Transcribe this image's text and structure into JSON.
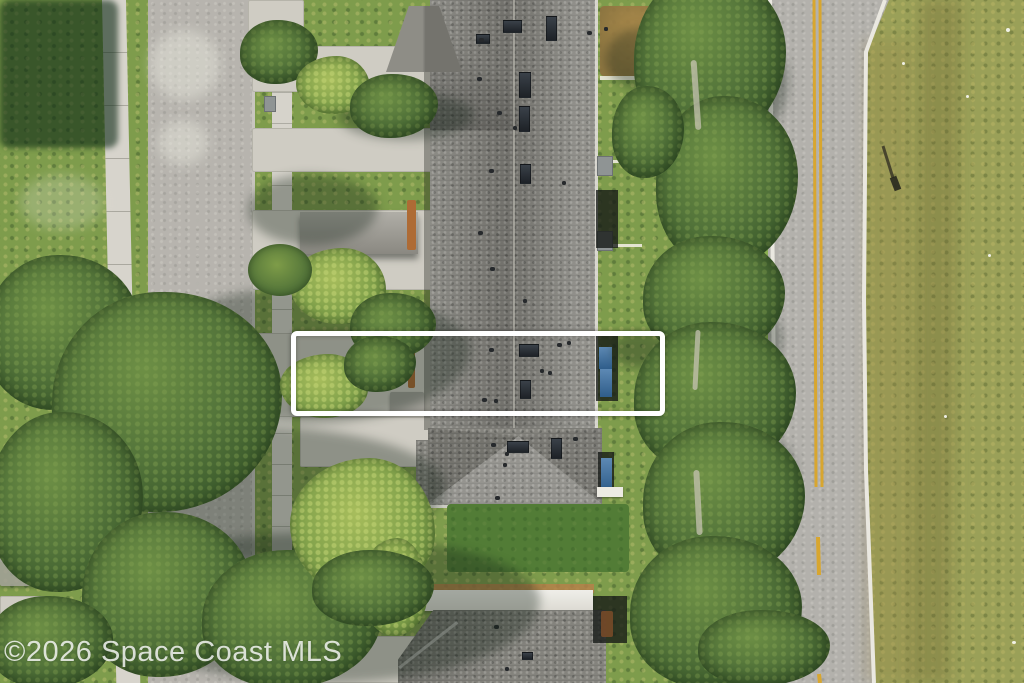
{
  "scene": {
    "kind": "aerial-drone-photo",
    "subject": "townhome community between residential street and two-lane road",
    "width": 1024,
    "height": 683
  },
  "watermark": {
    "text": "©2026 Space Coast MLS"
  },
  "highlight_box": {
    "x": 291,
    "y": 331,
    "w": 374,
    "h": 85,
    "border_color": "#ffffff",
    "border_px": 5
  },
  "palette": {
    "grass": "#7e9c4c",
    "field": "#9aa058",
    "street": "#b7b4ae",
    "road": "#b3b1ac",
    "concrete": "#d7d4cc",
    "roof": "#84837d",
    "back_lawn": "#527c36",
    "yellow_line": "#d8a62f",
    "white_line": "#eae8e0",
    "tree": "#53743a",
    "dirt_yard": "#a9824a"
  },
  "markings": [
    {
      "name": "road-edge-line-left",
      "d": "M770,0 L777,683",
      "stroke": "#eae8e0",
      "w": 4
    },
    {
      "name": "road-edge-line-right",
      "d": "M885,0 L866,52 L864,300 L866,470 L874,683",
      "stroke": "#eae8e0",
      "w": 4
    },
    {
      "name": "center-line-yellow-1",
      "d": "M814,0 L816,487",
      "stroke": "#d8a62f",
      "w": 3
    },
    {
      "name": "center-line-yellow-2",
      "d": "M820,0 L822,487",
      "stroke": "#d8a62f",
      "w": 3
    },
    {
      "name": "center-line-dash",
      "d": "M818,537 L819,575",
      "stroke": "#d8a62f",
      "w": 4
    },
    {
      "name": "center-line-dash",
      "d": "M819,674 L820,683",
      "stroke": "#d8a62f",
      "w": 4
    },
    {
      "name": "streetlight-shadow",
      "d": "M287,612 L300,592 L333,671",
      "stroke": "rgba(35,38,32,0.8)",
      "w": 3
    },
    {
      "name": "pole-shadow",
      "d": "M883,146 L893,178",
      "stroke": "rgba(50,48,35,0.8)",
      "w": 3
    },
    {
      "name": "pole-shadow-head",
      "d": "M893,177 L898,190",
      "stroke": "rgba(40,40,30,0.9)",
      "w": 7
    }
  ],
  "sprites": {
    "ground": [
      {
        "n": "driveway",
        "c": "concrete-pad",
        "x": 248,
        "y": 0,
        "w": 56,
        "h": 40
      },
      {
        "n": "driveway",
        "c": "concrete-pad",
        "x": 252,
        "y": 46,
        "w": 180,
        "h": 46
      },
      {
        "n": "driveway",
        "c": "concrete-pad",
        "x": 252,
        "y": 128,
        "w": 180,
        "h": 44
      },
      {
        "n": "driveway",
        "c": "concrete-pad",
        "x": 252,
        "y": 210,
        "w": 180,
        "h": 80
      },
      {
        "n": "driveway",
        "c": "concrete-pad",
        "x": 252,
        "y": 333,
        "w": 180,
        "h": 84
      },
      {
        "n": "driveway",
        "c": "concrete-pad",
        "x": 300,
        "y": 417,
        "w": 132,
        "h": 50
      },
      {
        "n": "driveway",
        "c": "concrete-pad",
        "x": 252,
        "y": 636,
        "w": 180,
        "h": 47
      },
      {
        "n": "walk-path",
        "c": "concrete-pad",
        "x": 0,
        "y": 455,
        "w": 112,
        "h": 26
      },
      {
        "n": "walk-path",
        "c": "concrete-pad",
        "x": 0,
        "y": 538,
        "w": 58,
        "h": 24
      },
      {
        "n": "walk-path",
        "c": "concrete-pad",
        "x": 0,
        "y": 596,
        "w": 46,
        "h": 28
      },
      {
        "n": "path-behind-trees",
        "c": "concrete-pad",
        "x": 710,
        "y": 74,
        "w": 32,
        "h": 40
      },
      {
        "n": "path-behind-trees",
        "c": "concrete-pad",
        "x": 712,
        "y": 166,
        "w": 30,
        "h": 46
      },
      {
        "n": "path-behind-trees",
        "c": "concrete-pad",
        "x": 713,
        "y": 290,
        "w": 28,
        "h": 42
      },
      {
        "n": "pavement-blotch",
        "c": "blotch",
        "x": 150,
        "y": 30,
        "w": 70,
        "h": 70
      },
      {
        "n": "pavement-blotch",
        "c": "blotch",
        "x": 158,
        "y": 120,
        "w": 50,
        "h": 45
      },
      {
        "n": "dry-grass-patch",
        "c": "blotch",
        "x": 20,
        "y": 175,
        "w": 85,
        "h": 55,
        "o": 0.55
      },
      {
        "n": "manhole",
        "c": "manhole",
        "x": 204,
        "y": 543,
        "w": 7,
        "h": 6
      },
      {
        "n": "manhole",
        "c": "manhole",
        "x": 227,
        "y": 540,
        "w": 5,
        "h": 5
      },
      {
        "n": "utility-pad",
        "c": "acpad",
        "x": 264,
        "y": 96,
        "w": 10,
        "h": 14
      },
      {
        "n": "utility-box-green",
        "c": "acpad",
        "x": 127,
        "y": 521,
        "w": 8,
        "h": 7
      },
      {
        "n": "utility-box-blue",
        "c": "utility-box",
        "x": 282,
        "y": 604,
        "w": 9,
        "h": 10
      },
      {
        "n": "neighbor-roof",
        "c": "grayroof",
        "x": 0,
        "y": 538,
        "w": 46,
        "h": 48,
        "o": 0.85
      },
      {
        "n": "neighbor-structure",
        "c": "wallstrip",
        "x": 6,
        "y": 486,
        "w": 28,
        "h": 24,
        "o": 0.6
      },
      {
        "n": "dirt-yard",
        "c": "dirt",
        "x": 600,
        "y": 6,
        "w": 72,
        "h": 70
      },
      {
        "n": "field-swale",
        "c": "fieldband",
        "x": 914,
        "y": 0,
        "w": 42,
        "h": 683,
        "r": 1
      },
      {
        "n": "field-edge-band",
        "c": "fieldband2",
        "x": 864,
        "y": 40,
        "w": 48,
        "h": 643
      },
      {
        "n": "field-rock",
        "c": "speck",
        "x": 1006,
        "y": 28,
        "w": 4,
        "h": 4
      },
      {
        "n": "field-rock",
        "c": "speck",
        "x": 966,
        "y": 95,
        "w": 3,
        "h": 3
      },
      {
        "n": "field-rock",
        "c": "speck",
        "x": 988,
        "y": 254,
        "w": 3,
        "h": 3
      },
      {
        "n": "field-rock",
        "c": "speck",
        "x": 944,
        "y": 415,
        "w": 3,
        "h": 3
      },
      {
        "n": "field-rock",
        "c": "speck",
        "x": 1012,
        "y": 641,
        "w": 4,
        "h": 3
      },
      {
        "n": "field-rock",
        "c": "speck",
        "x": 902,
        "y": 62,
        "w": 3,
        "h": 3
      }
    ],
    "details": [
      {
        "n": "skylight",
        "c": "skylight",
        "x": 503,
        "y": 20,
        "w": 17,
        "h": 11
      },
      {
        "n": "skylight",
        "c": "skylight",
        "x": 546,
        "y": 16,
        "w": 9,
        "h": 23
      },
      {
        "n": "skylight",
        "c": "skylight",
        "x": 476,
        "y": 34,
        "w": 12,
        "h": 8
      },
      {
        "n": "skylight",
        "c": "skylight",
        "x": 519,
        "y": 72,
        "w": 10,
        "h": 24
      },
      {
        "n": "skylight",
        "c": "skylight",
        "x": 519,
        "y": 106,
        "w": 9,
        "h": 24
      },
      {
        "n": "skylight",
        "c": "skylight",
        "x": 520,
        "y": 164,
        "w": 9,
        "h": 18
      },
      {
        "n": "skylight",
        "c": "skylight",
        "x": 519,
        "y": 344,
        "w": 18,
        "h": 11
      },
      {
        "n": "skylight",
        "c": "skylight",
        "x": 520,
        "y": 380,
        "w": 9,
        "h": 17
      },
      {
        "n": "skylight",
        "c": "skylight",
        "x": 507,
        "y": 441,
        "w": 20,
        "h": 10
      },
      {
        "n": "skylight",
        "c": "skylight",
        "x": 551,
        "y": 438,
        "w": 9,
        "h": 19
      },
      {
        "n": "skylight",
        "c": "skylight",
        "x": 522,
        "y": 652,
        "w": 9,
        "h": 6
      },
      {
        "n": "roof-vent",
        "c": "vent",
        "x": 479,
        "y": 38,
        "w": 5,
        "h": 4
      },
      {
        "n": "roof-vent",
        "c": "vent",
        "x": 587,
        "y": 31,
        "w": 5,
        "h": 4
      },
      {
        "n": "roof-vent",
        "c": "vent",
        "x": 604,
        "y": 27,
        "w": 4,
        "h": 4
      },
      {
        "n": "roof-vent",
        "c": "vent",
        "x": 477,
        "y": 77,
        "w": 5,
        "h": 4
      },
      {
        "n": "roof-vent",
        "c": "vent",
        "x": 497,
        "y": 111,
        "w": 5,
        "h": 4
      },
      {
        "n": "roof-vent",
        "c": "vent",
        "x": 513,
        "y": 126,
        "w": 4,
        "h": 4
      },
      {
        "n": "roof-vent",
        "c": "vent",
        "x": 489,
        "y": 169,
        "w": 5,
        "h": 4
      },
      {
        "n": "roof-vent",
        "c": "vent",
        "x": 562,
        "y": 181,
        "w": 4,
        "h": 4
      },
      {
        "n": "roof-vent",
        "c": "vent",
        "x": 478,
        "y": 231,
        "w": 5,
        "h": 4
      },
      {
        "n": "roof-vent",
        "c": "vent",
        "x": 490,
        "y": 267,
        "w": 5,
        "h": 4
      },
      {
        "n": "roof-vent",
        "c": "vent",
        "x": 523,
        "y": 299,
        "w": 4,
        "h": 4
      },
      {
        "n": "roof-vent",
        "c": "vent",
        "x": 489,
        "y": 348,
        "w": 5,
        "h": 4
      },
      {
        "n": "roof-vent",
        "c": "vent",
        "x": 557,
        "y": 343,
        "w": 5,
        "h": 4
      },
      {
        "n": "roof-vent",
        "c": "vent",
        "x": 567,
        "y": 341,
        "w": 4,
        "h": 4
      },
      {
        "n": "roof-vent",
        "c": "vent",
        "x": 540,
        "y": 369,
        "w": 4,
        "h": 4
      },
      {
        "n": "roof-vent",
        "c": "vent",
        "x": 548,
        "y": 371,
        "w": 4,
        "h": 4
      },
      {
        "n": "roof-vent",
        "c": "vent",
        "x": 482,
        "y": 398,
        "w": 5,
        "h": 4
      },
      {
        "n": "roof-vent",
        "c": "vent",
        "x": 494,
        "y": 399,
        "w": 4,
        "h": 4
      },
      {
        "n": "roof-vent",
        "c": "vent",
        "x": 491,
        "y": 443,
        "w": 5,
        "h": 4
      },
      {
        "n": "roof-vent",
        "c": "vent",
        "x": 573,
        "y": 437,
        "w": 5,
        "h": 4
      },
      {
        "n": "roof-vent",
        "c": "vent",
        "x": 505,
        "y": 452,
        "w": 4,
        "h": 4
      },
      {
        "n": "roof-vent",
        "c": "vent",
        "x": 503,
        "y": 463,
        "w": 4,
        "h": 4
      },
      {
        "n": "roof-vent",
        "c": "vent",
        "x": 495,
        "y": 496,
        "w": 5,
        "h": 4
      },
      {
        "n": "roof-vent",
        "c": "vent",
        "x": 494,
        "y": 625,
        "w": 5,
        "h": 4
      },
      {
        "n": "roof-vent",
        "c": "vent",
        "x": 505,
        "y": 667,
        "w": 4,
        "h": 4
      },
      {
        "n": "fence",
        "c": "fence",
        "x": 600,
        "y": 76,
        "w": 72,
        "h": 4
      },
      {
        "n": "fence",
        "c": "fence",
        "x": 600,
        "y": 160,
        "w": 44,
        "h": 3
      },
      {
        "n": "fence",
        "c": "fence",
        "x": 600,
        "y": 244,
        "w": 42,
        "h": 3
      },
      {
        "n": "fence",
        "c": "fence",
        "x": 667,
        "y": 0,
        "w": 4,
        "h": 78
      },
      {
        "n": "ac-unit",
        "c": "acpad",
        "x": 597,
        "y": 156,
        "w": 14,
        "h": 18
      },
      {
        "n": "ac-unit",
        "c": "acpad",
        "x": 597,
        "y": 231,
        "w": 14,
        "h": 18
      },
      {
        "n": "screened-lanai",
        "c": "lanai-shade",
        "x": 596,
        "y": 190,
        "w": 22,
        "h": 58
      },
      {
        "n": "screened-lanai",
        "c": "lanai-shade",
        "x": 596,
        "y": 333,
        "w": 22,
        "h": 68
      },
      {
        "n": "screened-lanai",
        "c": "lanai-shade",
        "x": 598,
        "y": 452,
        "w": 16,
        "h": 44
      },
      {
        "n": "screened-lanai",
        "c": "lanai-shade",
        "x": 593,
        "y": 596,
        "w": 34,
        "h": 47
      },
      {
        "n": "lanai-glass",
        "c": "blue-panel",
        "x": 599,
        "y": 347,
        "w": 13,
        "h": 22
      },
      {
        "n": "lanai-glass",
        "c": "blue-panel",
        "x": 600,
        "y": 369,
        "w": 12,
        "h": 28
      },
      {
        "n": "lanai-glass",
        "c": "blue-panel",
        "x": 601,
        "y": 458,
        "w": 11,
        "h": 33
      },
      {
        "n": "awning-white",
        "c": "white-bit",
        "x": 597,
        "y": 487,
        "w": 26,
        "h": 10
      },
      {
        "n": "patio-furniture",
        "c": "furn",
        "x": 601,
        "y": 611,
        "w": 12,
        "h": 26
      },
      {
        "n": "carport-wall",
        "c": "wallstrip",
        "x": 407,
        "y": 200,
        "w": 9,
        "h": 50
      },
      {
        "n": "carport-wall",
        "c": "wallstrip",
        "x": 408,
        "y": 346,
        "w": 7,
        "h": 42
      },
      {
        "n": "entry-roof",
        "c": "grayroof",
        "x": 390,
        "y": 392,
        "w": 34,
        "h": 20
      }
    ],
    "veg": [
      {
        "n": "tree-shadow",
        "c": "shadow-blob",
        "x": 150,
        "y": 288,
        "w": 320,
        "h": 135
      },
      {
        "n": "tree-shadow",
        "c": "shadow-blob",
        "x": 60,
        "y": 425,
        "w": 385,
        "h": 135
      },
      {
        "n": "tree-shadow",
        "c": "shadow-blob",
        "x": 110,
        "y": 533,
        "w": 430,
        "h": 150
      },
      {
        "n": "tree-shadow",
        "c": "shadow-blob",
        "x": 248,
        "y": 175,
        "w": 130,
        "h": 70
      },
      {
        "n": "tree-shadow",
        "c": "shadow-blob",
        "x": 338,
        "y": 92,
        "w": 135,
        "h": 48
      },
      {
        "n": "tree-shadow",
        "c": "shadow-blob",
        "x": 612,
        "y": 332,
        "w": 55,
        "h": 36
      },
      {
        "n": "tree-shadow",
        "c": "shadow-blob",
        "x": 688,
        "y": 28,
        "w": 100,
        "h": 115
      },
      {
        "n": "tree-shadow",
        "c": "shadow-blob",
        "x": 698,
        "y": 148,
        "w": 85,
        "h": 85
      },
      {
        "n": "tree-shadow",
        "c": "shadow-blob",
        "x": 692,
        "y": 298,
        "w": 90,
        "h": 88
      },
      {
        "n": "tree-shadow",
        "c": "shadow-blob",
        "x": 700,
        "y": 428,
        "w": 95,
        "h": 98
      },
      {
        "n": "tree-shadow",
        "c": "shadow-blob",
        "x": 688,
        "y": 558,
        "w": 105,
        "h": 92
      },
      {
        "n": "tree-shadow",
        "c": "shadow-blob",
        "x": 606,
        "y": 28,
        "w": 75,
        "h": 62
      },
      {
        "n": "tree-shadow",
        "c": "shadow-blob",
        "x": 690,
        "y": 648,
        "w": 100,
        "h": 35
      },
      {
        "n": "tree-shadow-on-lawn",
        "c": "dark-shadow",
        "x": 0,
        "y": 0,
        "w": 118,
        "h": 148
      },
      {
        "n": "tree-canopy",
        "c": "canopy",
        "x": -15,
        "y": 255,
        "w": 155,
        "h": 155
      },
      {
        "n": "tree-canopy",
        "c": "canopy",
        "x": 52,
        "y": 292,
        "w": 230,
        "h": 220
      },
      {
        "n": "tree-canopy",
        "c": "canopy",
        "x": -12,
        "y": 412,
        "w": 155,
        "h": 180
      },
      {
        "n": "tree-canopy",
        "c": "canopy",
        "x": 82,
        "y": 512,
        "w": 170,
        "h": 165
      },
      {
        "n": "tree-canopy",
        "c": "canopy",
        "x": 202,
        "y": 550,
        "w": 180,
        "h": 138
      },
      {
        "n": "tree-canopy",
        "c": "canopy",
        "x": -12,
        "y": 596,
        "w": 125,
        "h": 92
      },
      {
        "n": "tree-canopy",
        "c": "canopy",
        "x": 240,
        "y": 20,
        "w": 78,
        "h": 64
      },
      {
        "n": "palm-cluster",
        "c": "palm",
        "x": 296,
        "y": 56,
        "w": 74,
        "h": 58
      },
      {
        "n": "tree-canopy",
        "c": "canopy",
        "x": 350,
        "y": 74,
        "w": 88,
        "h": 64
      },
      {
        "n": "palm-cluster",
        "c": "palm",
        "x": 290,
        "y": 248,
        "w": 96,
        "h": 76
      },
      {
        "n": "tree-canopy",
        "c": "canopy",
        "x": 350,
        "y": 293,
        "w": 86,
        "h": 66
      },
      {
        "n": "shrub",
        "c": "shrub",
        "x": 248,
        "y": 244,
        "w": 64,
        "h": 52
      },
      {
        "n": "palm-cluster",
        "c": "palm",
        "x": 280,
        "y": 354,
        "w": 88,
        "h": 64
      },
      {
        "n": "tree-canopy",
        "c": "canopy",
        "x": 344,
        "y": 336,
        "w": 72,
        "h": 56
      },
      {
        "n": "palm-cluster",
        "c": "palm",
        "x": 290,
        "y": 458,
        "w": 145,
        "h": 138
      },
      {
        "n": "palm-cluster",
        "c": "palm",
        "x": 360,
        "y": 538,
        "w": 68,
        "h": 98
      },
      {
        "n": "tree-canopy",
        "c": "canopy",
        "x": 312,
        "y": 550,
        "w": 122,
        "h": 76
      },
      {
        "n": "tree-canopy",
        "c": "canopy",
        "x": 634,
        "y": -28,
        "w": 152,
        "h": 172
      },
      {
        "n": "tree-canopy",
        "c": "canopy",
        "x": 656,
        "y": 96,
        "w": 142,
        "h": 172
      },
      {
        "n": "tree-canopy",
        "c": "canopy",
        "x": 612,
        "y": 86,
        "w": 72,
        "h": 92
      },
      {
        "n": "tree-canopy",
        "c": "canopy",
        "x": 643,
        "y": 236,
        "w": 142,
        "h": 122
      },
      {
        "n": "tree-canopy",
        "c": "canopy",
        "x": 634,
        "y": 322,
        "w": 162,
        "h": 152
      },
      {
        "n": "tree-canopy",
        "c": "canopy",
        "x": 643,
        "y": 422,
        "w": 162,
        "h": 158
      },
      {
        "n": "tree-canopy",
        "c": "canopy",
        "x": 630,
        "y": 536,
        "w": 172,
        "h": 152
      },
      {
        "n": "tree-canopy",
        "c": "canopy",
        "x": 698,
        "y": 610,
        "w": 132,
        "h": 76
      },
      {
        "n": "tree-trunk",
        "c": "trunk",
        "x": 693,
        "y": 60,
        "w": 6,
        "h": 70,
        "r": -4
      },
      {
        "n": "tree-trunk",
        "c": "trunk",
        "x": 694,
        "y": 330,
        "w": 5,
        "h": 60,
        "r": 3
      },
      {
        "n": "tree-trunk",
        "c": "trunk",
        "x": 695,
        "y": 470,
        "w": 6,
        "h": 65,
        "r": -3
      }
    ]
  }
}
